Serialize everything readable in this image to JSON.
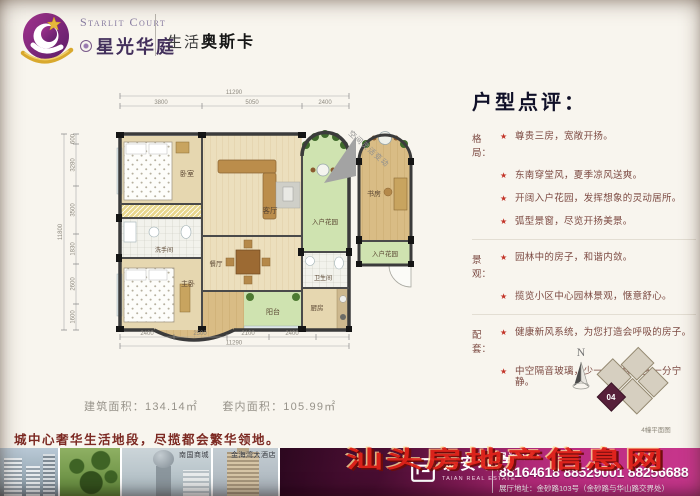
{
  "header": {
    "brand_en": "Starlit Court",
    "brand_cn": "星光华庭",
    "tagline_prefix": "生活",
    "tagline_bold": "奥斯卡"
  },
  "review": {
    "title": "户型点评：",
    "star": "★",
    "rows": [
      {
        "cat": "格局：",
        "text": "尊贵三房，宽敞开扬。"
      },
      {
        "cat": "",
        "text": "东南穿堂风，夏季凉风送爽。"
      },
      {
        "cat": "",
        "text": "开阔入户花园，发挥想象的灵动居所。"
      },
      {
        "cat": "",
        "text": "弧型景窗，尽览开扬美景。"
      },
      {
        "cat": "景观：",
        "text": "园林中的房子，和谐内敛。"
      },
      {
        "cat": "",
        "text": "揽览小区中心园林景观，惬意舒心。"
      },
      {
        "cat": "配套：",
        "text": "健康新风系统，为您打造会呼吸的房子。"
      },
      {
        "cat": "",
        "text": "中空隔音玻璃，少一分浮躁，多一分宁静。"
      }
    ]
  },
  "plan": {
    "rooms": {
      "bedroom": "卧室",
      "master": "主卧",
      "living": "客厅",
      "dining": "餐厅",
      "kitchen": "厨房",
      "bath1": "洗手间",
      "bath2": "卫生间",
      "balcony": "阳台",
      "garden": "入户花园"
    },
    "mini": {
      "study": "书房",
      "garden": "入户花园"
    },
    "annotation": "空间灵活变动",
    "dims": {
      "top_total": "11290",
      "top": [
        "3800",
        "5050",
        "2400"
      ],
      "left_total": "11800",
      "left": [
        "600",
        "3280",
        "3500",
        "1830",
        "2600",
        "1600"
      ],
      "bottom": [
        "2400",
        "2500",
        "2100",
        "2400"
      ],
      "bottom_total": "11290"
    }
  },
  "areas": {
    "built": "建筑面积：134.14㎡",
    "inner": "套内面积：105.99㎡"
  },
  "slogan": "城中心奢华生活地段，尽揽都会繁华领地。",
  "keyplan": {
    "north": "N",
    "unit": "04",
    "caption": "4幢平面图"
  },
  "photos": {
    "captions": [
      "",
      "",
      "南国商城",
      "金海湾大酒店"
    ]
  },
  "footer": {
    "developer_cn": "泰安地产",
    "developer_en": "TAIAN REAL ESTATE",
    "hotline_label": "星光热线：",
    "phones": "88164618 88529001 88256688",
    "address": "展厅地址：金砂路103号（金砂路与华山路交界处）",
    "watermark": "汕头房地产信息网"
  },
  "colors": {
    "accent_magenta": "#b42a78",
    "brand_purple": "#6d2a7e",
    "wall": "#3b3b3b",
    "garden_green": "#cfe3b0",
    "watermark_red": "#e02318",
    "review_text": "#7c4a42"
  }
}
